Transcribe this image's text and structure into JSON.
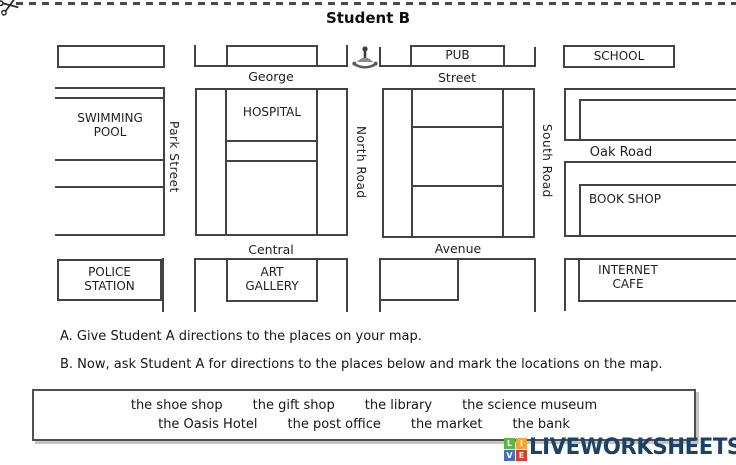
{
  "title": "Student B",
  "map": {
    "streets": {
      "george": "George",
      "street": "Street",
      "central": "Central",
      "avenue": "Avenue",
      "park_street": "Park Street",
      "north_road": "North Road",
      "south_road": "South Road",
      "oak_road": "Oak Road"
    },
    "places": {
      "pub": "PUB",
      "school": "SCHOOL",
      "swimming_pool": "SWIMMING POOL",
      "hospital": "HOSPITAL",
      "book_shop": "BOOK SHOP",
      "police_station": "POLICE STATION",
      "art_gallery": "ART GALLERY",
      "internet_cafe": "INTERNET CAFE"
    }
  },
  "instructions": {
    "a": "A. Give Student A directions to the places on your map.",
    "b": "B. Now, ask Student A for directions to the places below and mark the locations on the map."
  },
  "word_bank": {
    "row1": [
      "the shoe shop",
      "the gift shop",
      "the library",
      "the science museum"
    ],
    "row2": [
      "the Oasis Hotel",
      "the post office",
      "the market",
      "the bank"
    ]
  },
  "logo": {
    "text": "LIVEWORKSHEETS",
    "text_color": "#1d4266",
    "squares": [
      {
        "letter": "L",
        "color": "#58b747"
      },
      {
        "letter": "I",
        "color": "#f2a63c"
      },
      {
        "letter": "V",
        "color": "#4070c0"
      },
      {
        "letter": "E",
        "color": "#de3a2e"
      }
    ]
  },
  "colors": {
    "map_line": "#424242",
    "background": "#ffffff"
  }
}
